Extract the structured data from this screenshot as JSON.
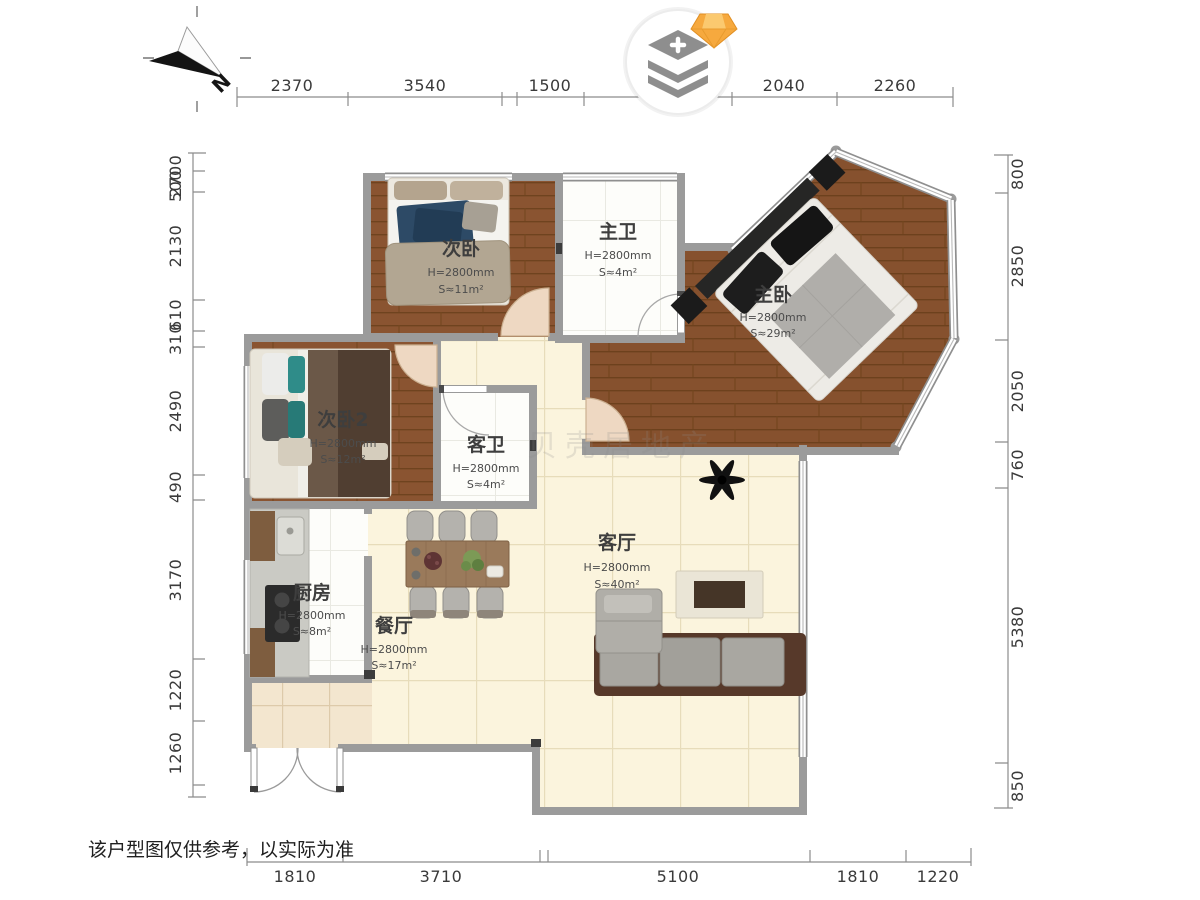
{
  "meta": {
    "disclaimer": "该户型图仅供参考，以实际为准",
    "north_label": "N",
    "watermark": "贝壳居地产"
  },
  "icons": {
    "badge": "layers-plus-icon",
    "gem": "diamond-gem-icon",
    "compass": "north-arrow-icon"
  },
  "colors": {
    "wall": "#9b9b9b",
    "wood_floor": "#8a5431",
    "cream_floor": "#fbf4dd",
    "accent_gem": "#f6a93e"
  },
  "rooms": [
    {
      "id": "ciwo",
      "name": "次卧",
      "height": "H=2800mm",
      "area": "S≈11m²"
    },
    {
      "id": "zhuwei",
      "name": "主卫",
      "height": "H=2800mm",
      "area": "S≈4m²"
    },
    {
      "id": "zhuwo",
      "name": "主卧",
      "height": "H=2800mm",
      "area": "S≈29m²"
    },
    {
      "id": "ciwo2",
      "name": "次卧2",
      "height": "H=2800mm",
      "area": "S≈12m²"
    },
    {
      "id": "kewei",
      "name": "客卫",
      "height": "H=2800mm",
      "area": "S≈4m²"
    },
    {
      "id": "chufang",
      "name": "厨房",
      "height": "H=2800mm",
      "area": "S≈8m²"
    },
    {
      "id": "canting",
      "name": "餐厅",
      "height": "H=2800mm",
      "area": "S≈17m²"
    },
    {
      "id": "keting",
      "name": "客厅",
      "height": "H=2800mm",
      "area": "S≈40m²"
    }
  ],
  "dimensions": {
    "top": [
      "2370",
      "3540",
      "1500",
      "2040",
      "2260"
    ],
    "left": [
      "2700",
      "500",
      "2130",
      "610",
      "310",
      "2490",
      "490",
      "3170",
      "1220",
      "1260"
    ],
    "right": [
      "800",
      "2850",
      "2050",
      "760",
      "5380",
      "850"
    ],
    "bottom": [
      "1810",
      "3710",
      "5100",
      "1810",
      "1220"
    ]
  }
}
